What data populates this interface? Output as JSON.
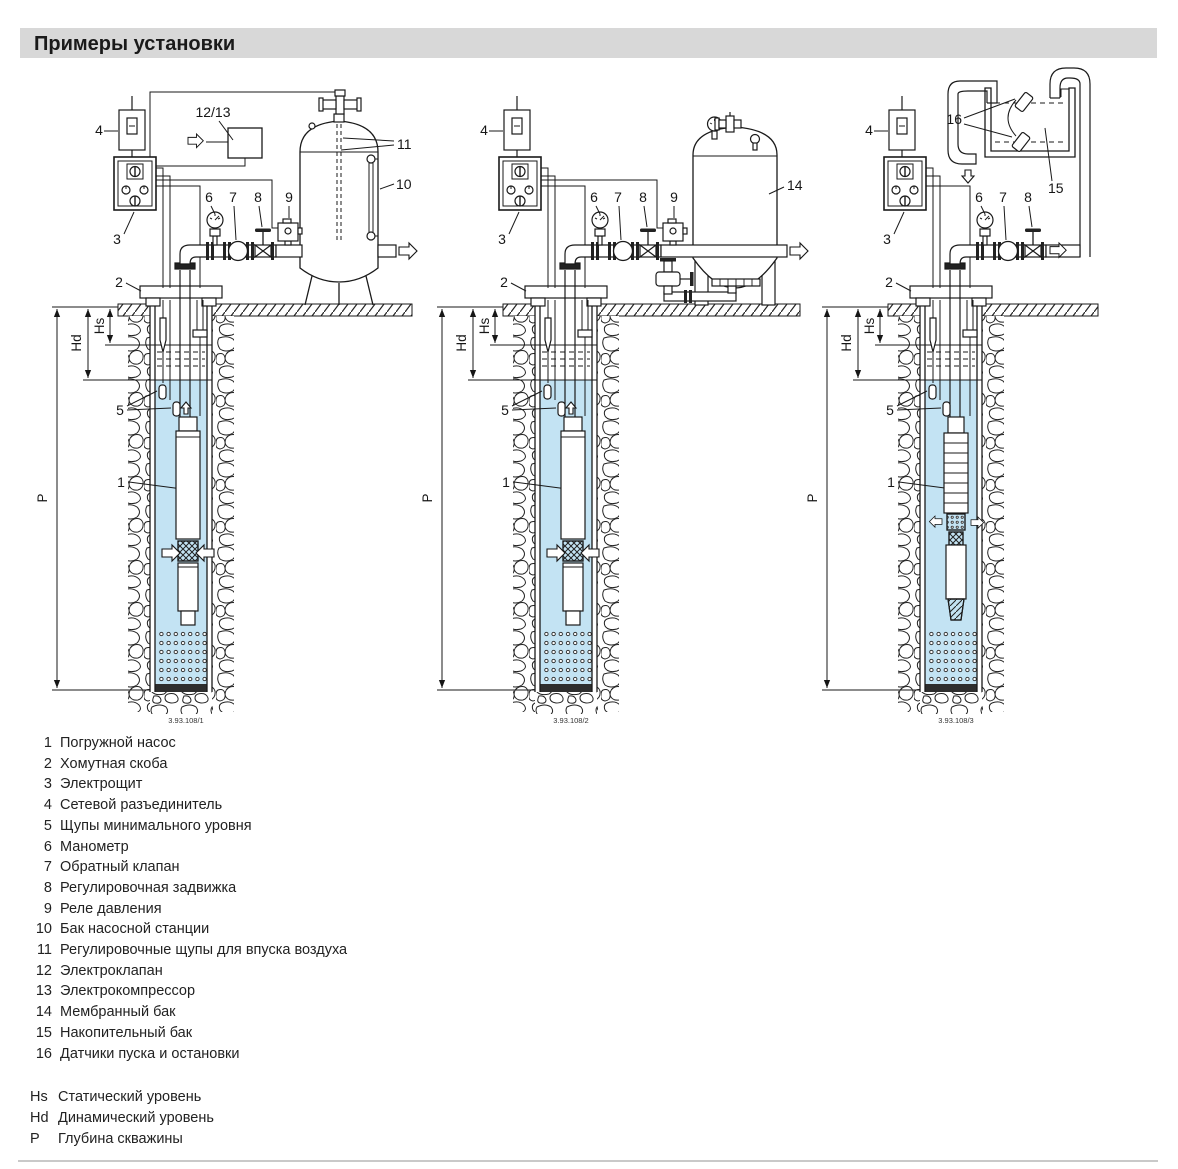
{
  "title": "Примеры установки",
  "colors": {
    "water": "#c3e3f3",
    "title_bar": "#d8d8d8",
    "line": "#1a1a1a"
  },
  "dims": {
    "hs": "Hs",
    "hd": "Hd",
    "p": "P"
  },
  "diagrams": [
    {
      "caption": "3.93.108/1",
      "labels": {
        "pump": "1",
        "clamp": "2",
        "panel": "3",
        "disconnect": "4",
        "probes": "5",
        "gauge": "6",
        "check_valve": "7",
        "reg_valve": "8",
        "pressure_switch": "9",
        "tank": "10",
        "air_probes": "11",
        "valve_compressor": "12/13"
      }
    },
    {
      "caption": "3.93.108/2",
      "labels": {
        "pump": "1",
        "clamp": "2",
        "panel": "3",
        "disconnect": "4",
        "probes": "5",
        "gauge": "6",
        "check_valve": "7",
        "reg_valve": "8",
        "pressure_switch": "9",
        "tank": "14"
      }
    },
    {
      "caption": "3.93.108/3",
      "labels": {
        "pump": "1",
        "clamp": "2",
        "panel": "3",
        "disconnect": "4",
        "probes": "5",
        "gauge": "6",
        "check_valve": "7",
        "reg_valve": "8",
        "tank": "15",
        "sensors": "16"
      }
    }
  ],
  "legend": {
    "items": [
      {
        "num": "1",
        "text": "Погружной насос"
      },
      {
        "num": "2",
        "text": "Хомутная скоба"
      },
      {
        "num": "3",
        "text": "Электрощит"
      },
      {
        "num": "4",
        "text": "Сетевой разъединитель"
      },
      {
        "num": "5",
        "text": "Щупы минимального уровня"
      },
      {
        "num": "6",
        "text": "Манометр"
      },
      {
        "num": "7",
        "text": "Обратный клапан"
      },
      {
        "num": "8",
        "text": "Регулировочная задвижка"
      },
      {
        "num": "9",
        "text": "Реле давления"
      },
      {
        "num": "10",
        "text": "Бак насосной станции"
      },
      {
        "num": "11",
        "text": "Регулировочные щупы для впуска воздуха"
      },
      {
        "num": "12",
        "text": "Электроклапан"
      },
      {
        "num": "13",
        "text": "Электрокомпрессор"
      },
      {
        "num": "14",
        "text": "Мембранный бак"
      },
      {
        "num": "15",
        "text": "Накопительный бак"
      },
      {
        "num": "16",
        "text": "Датчики пуска и остановки"
      }
    ]
  },
  "levels": [
    {
      "key": "Hs",
      "text": "Статический уровень"
    },
    {
      "key": "Hd",
      "text": "Динамический уровень"
    },
    {
      "key": "P",
      "text": "Глубина скважины"
    }
  ]
}
